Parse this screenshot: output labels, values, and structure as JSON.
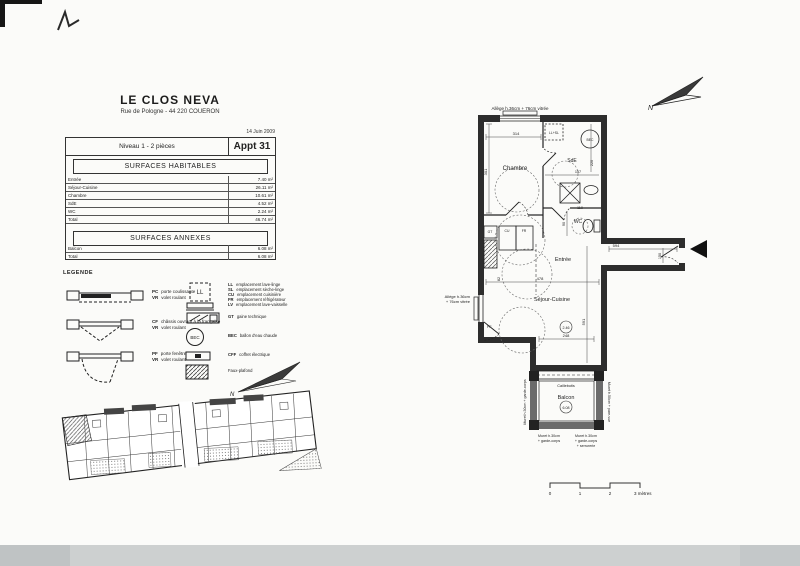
{
  "header": {
    "title": "LE CLOS NEVA",
    "address": "Rue de Pologne - 44 220 COUERON",
    "date": "14 Juin 2009",
    "level": "Niveau 1 - 2 pièces",
    "apartment": "Appt 31"
  },
  "surfaces_habitables": {
    "title": "SURFACES HABITABLES",
    "rows": [
      {
        "label": "Entrée",
        "value": "7.40 m²"
      },
      {
        "label": "Séjour-Cuisine",
        "value": "26.11 m²"
      },
      {
        "label": "Chambre",
        "value": "10.61 m²"
      },
      {
        "label": "SdE",
        "value": "4.52 m²"
      },
      {
        "label": "WC",
        "value": "2.24 m²"
      }
    ],
    "total": {
      "label": "Total",
      "value": "46.74 m²"
    }
  },
  "surfaces_annexes": {
    "title": "SURFACES ANNEXES",
    "rows": [
      {
        "label": "Balcon",
        "value": "6.08 m²"
      }
    ],
    "total": {
      "label": "Total",
      "value": "6.08 m²"
    }
  },
  "legend": {
    "title": "LEGENDE",
    "openings": [
      {
        "abbr1": "PC",
        "label1": "porte coulissante",
        "abbr2": "VR",
        "label2": "volet roulant"
      },
      {
        "abbr1": "CF",
        "label1": "châssis ouvrant à la française",
        "abbr2": "VR",
        "label2": "volet roulant"
      },
      {
        "abbr1": "PF",
        "label1": "porte fenêtre",
        "abbr2": "VR",
        "label2": "volet roulant"
      }
    ],
    "ll_box": "LL",
    "equipment": [
      {
        "abbr": "LL",
        "label": "emplacement lave-linge"
      },
      {
        "abbr": "SL",
        "label": "emplacement sèche-linge"
      },
      {
        "abbr": "CU",
        "label": "emplacement cuisinière"
      },
      {
        "abbr": "FR",
        "label": "emplacement réfrigérateur"
      },
      {
        "abbr": "LV",
        "label": "emplacement lave-vaisselle"
      }
    ],
    "gt": {
      "abbr": "GT",
      "label": "gaine technique"
    },
    "bec": {
      "abbr": "BEC",
      "label": "ballon d'eau chaude"
    },
    "coffret": {
      "abbr": "CFF",
      "label": "coffret électrique"
    },
    "faux_plafond": "Faux-plafond"
  },
  "plan": {
    "window_top": "Allège h.36cm + 76cm vitrée",
    "window_left_1": "Allège h.36cm",
    "window_left_2": "+ 76cm vitrée",
    "rooms": {
      "chambre": "Chambre",
      "sde": "SdE",
      "wc": "WC",
      "entree": "Entrée",
      "sejour": "Séjour-Cuisine",
      "balcon": "Balcon"
    },
    "labels": {
      "ll_sl": "LL+SL",
      "bec": "BEC",
      "gt": "GT",
      "cu": "CU",
      "fr": "FR",
      "pf": "PF",
      "caillebotis": "Caillebotis",
      "balcon_area": "6.08",
      "sejour_circle": "2.46"
    },
    "dims": {
      "chambre_w": "314",
      "chambre_h": "301",
      "sde_w": "157",
      "sde_h": "220",
      "basin": "110",
      "wc_h": "90",
      "corridor": "594",
      "door": "150",
      "sejour_w": "478",
      "kitchen": "82",
      "sejour_h": "591",
      "balcon_door": "248"
    },
    "murets": {
      "left": "Muret h.30cm + garde-corps",
      "right": "Muret h.50cm + pare-vue",
      "bottom_left_1": "Muret h.30cm",
      "bottom_left_2": "+ garde-corps",
      "bottom_right_1": "Muret h.30cm",
      "bottom_right_2": "+ garde-corps",
      "bottom_right_3": "+ serrurerie"
    }
  },
  "north": {
    "label": "N"
  },
  "scalebar": {
    "t0": "0",
    "t1": "1",
    "t2": "2",
    "t3": "3 mètres"
  }
}
